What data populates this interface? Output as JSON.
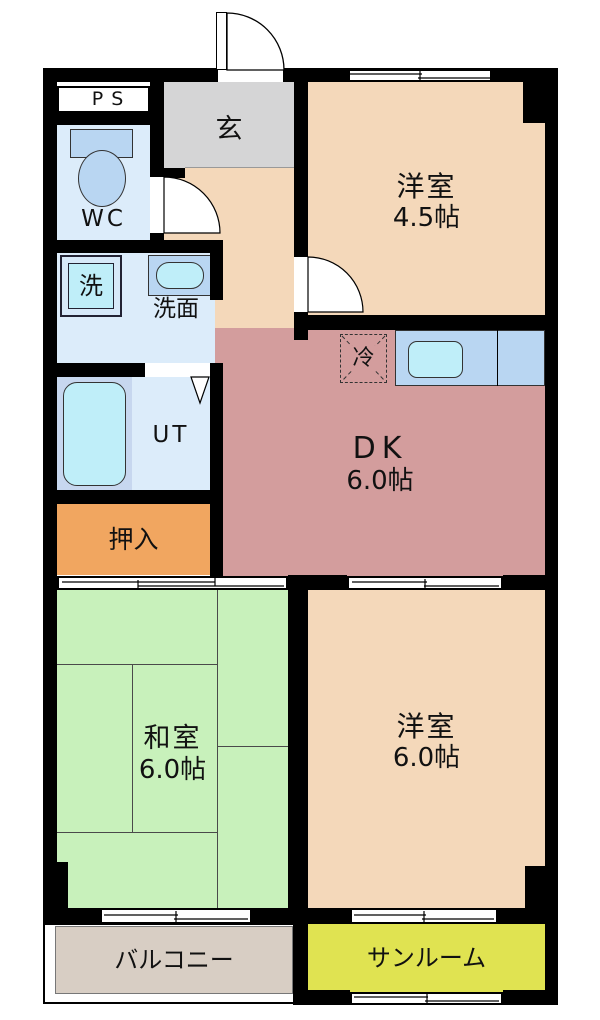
{
  "rooms": {
    "ps": {
      "label": "PS"
    },
    "wc": {
      "label": "WC",
      "bg": "#dcecfa"
    },
    "genkan": {
      "label": "玄",
      "bg": "#d5d5d6"
    },
    "hall": {
      "bg": "#f4d8ba"
    },
    "western_room_45": {
      "label": "洋室",
      "size": "4.5帖",
      "bg": "#f4d8ba"
    },
    "washroom": {
      "label": "洗面",
      "bg": "#dcecfa"
    },
    "washer": {
      "label": "洗"
    },
    "dk": {
      "label": "DK",
      "size": "6.0帖",
      "bg": "#d39d9d"
    },
    "fridge": {
      "label": "冷"
    },
    "bath": {
      "bg": "#c7d7ef"
    },
    "ut": {
      "label": "UT",
      "bg": "#dcecfa"
    },
    "oshiire": {
      "label": "押入",
      "bg": "#f1a660"
    },
    "washitsu": {
      "label": "和室",
      "size": "6.0帖",
      "bg": "#c8f1bb"
    },
    "western_room_6": {
      "label": "洋室",
      "size": "6.0帖",
      "bg": "#f4d8ba"
    },
    "balcony": {
      "label": "バルコニー",
      "bg": "#d8cec4"
    },
    "sunroom": {
      "label": "サンルーム",
      "bg": "#e0e351"
    }
  },
  "colors": {
    "wall": "#000000",
    "fixture_counter": "#b9d6f2",
    "fixture_basin": "#bfeef9"
  }
}
